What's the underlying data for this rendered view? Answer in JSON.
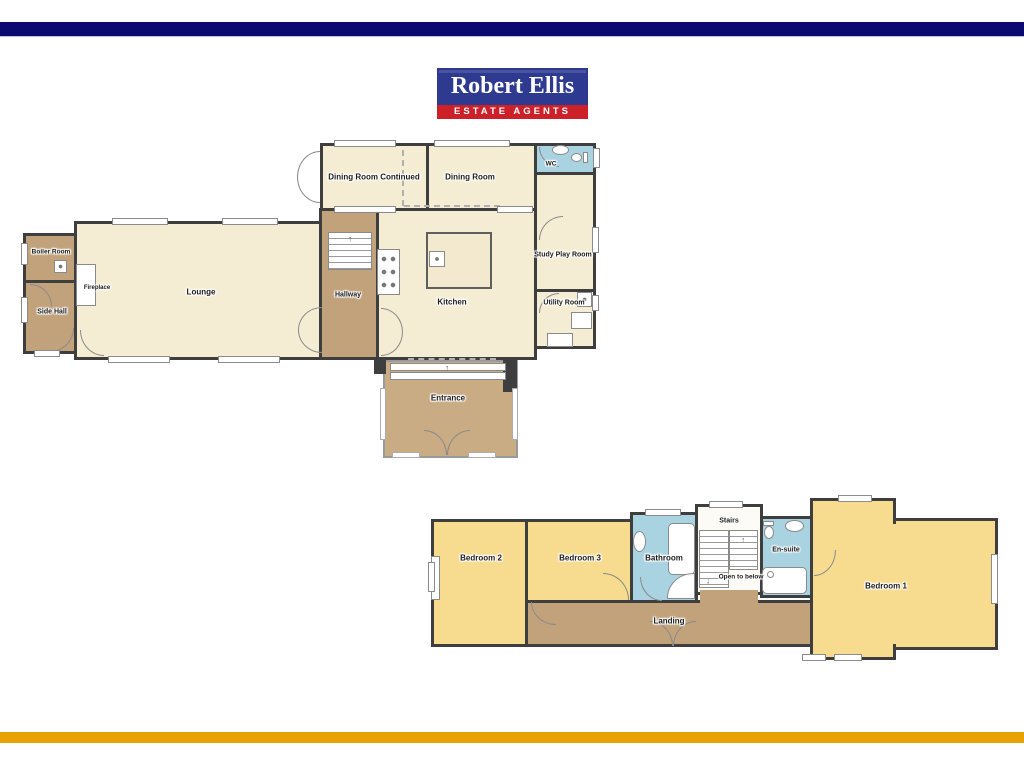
{
  "brand": {
    "name": "Robert Ellis",
    "tagline": "ESTATE AGENTS"
  },
  "colors": {
    "navy": "#0a0a70",
    "gold": "#e8a303",
    "logo_blue": "#2e3a90",
    "logo_red": "#cc2129",
    "wall": "#3e3e3e",
    "cream": "#f5edd3",
    "yellow": "#f7db8e",
    "tan": "#c2a27b",
    "tan_light": "#c9ab84",
    "blue": "#aad3e2"
  },
  "ground_floor": {
    "dining_continued": "Dining Room Continued",
    "dining": "Dining Room",
    "wc": "WC",
    "study": "Study Play Room",
    "utility": "Utility Room",
    "kitchen": "Kitchen",
    "hallway": "Hallway",
    "lounge": "Lounge",
    "fireplace": "Fireplace",
    "boiler": "Boiler Room",
    "side_hall": "Side Hall",
    "entrance": "Entrance"
  },
  "first_floor": {
    "bedroom1": "Bedroom 1",
    "bedroom2": "Bedroom 2",
    "bedroom3": "Bedroom 3",
    "bathroom": "Bathroom",
    "stairs": "Stairs",
    "open_to_below": "Open to below",
    "ensuite": "En-suite",
    "landing": "Landing"
  },
  "icons": {
    "arrow_up": "↑",
    "arrow_down": "↓"
  }
}
